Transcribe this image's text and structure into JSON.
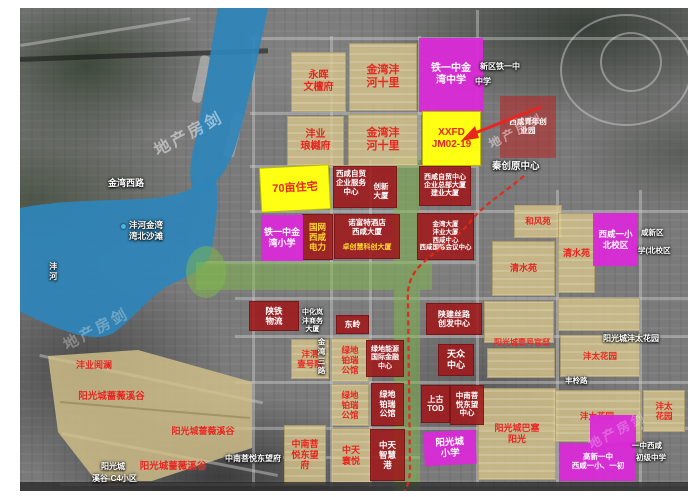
{
  "watermark": {
    "text": "地产房剑"
  },
  "parcels": {
    "yonghui_wentanfu": "永晖\n文檀府",
    "jinwan_fenghe_shili_n": "金湾沣\n河十里",
    "fengye_langyuefu": "沣业\n琅樾府",
    "jinwan_fenghe_shili_s": "金湾沣\n河十里",
    "tieyizhong_jinwan_zhongxue": "铁一中金\n湾中学",
    "xxfd": "XXFD\nJM02-19",
    "qishimu_zhuzhai": "70亩住宅",
    "ximao_fuwu": "西咸自贸\n企业服务\n中心",
    "chuangxin_dasha": "创新\n大厦",
    "ximao_zongbu": "西咸自贸中心\n企业总部大厦\n建业大厦",
    "qingnian_chuangyeyuan": "西咸青年创\n业园",
    "tieyizhong_jinwan_xiaoxue": "铁一中金\n湾小学",
    "guowang_dianli": "国网\n西咸\n电力",
    "nuofute_lines12": "诺富特酒店\n西咸大厦",
    "nuofute_line3": "卓创慧科创大厦",
    "jinwan_dasha": "金湾大厦\n沣业大厦\n西咸中心\n西咸国际会议中心",
    "hefengyuan": "和风苑",
    "qingshuiyuan_w": "清水苑",
    "qingshuiyuan_e": "清水苑",
    "xixian_yixiao_beixiaoqu": "西咸一小\n北校区",
    "shantie_wuliu": "陕铁\n物流",
    "dongling": "东岭",
    "fengwei_yihaoyuan": "沣渭\n壹号院",
    "lvdi_bairui_1": "绿地\n铂瑞\n公馆",
    "lvdi_nengyuan": "绿地能源\n国际金融\n中心",
    "lvdi_bairui_2": "绿地\n铂瑞\n公馆",
    "lvdi_bairui_3": "绿地\n铂瑞\n公馆",
    "shanjian_silu": "陕建丝路\n创发中心",
    "tianzhong_zhongxin": "天众\n中心",
    "shanggu_tod": "上古\nTOD",
    "zhongnan_dongwang_zhongxin": "中南菩\n悦东望\n中心",
    "fengye_yuelan": "沣业阅澜",
    "qiangwei_xigu_1": "阳光城蔷薇溪谷",
    "qiangwei_xigu_2": "阳光城蔷薇溪谷",
    "qiangwei_xigu_3": "阳光城蔷薇溪谷",
    "zhongnan_dongwangfu": "中南菩\n悦东望\n府",
    "zhongtian_huanyue": "中天\n寰悦",
    "zhongtian_zhihuigang": "中天\n智慧\n港",
    "yangguang_xiaoxue": "阳光城\n小学",
    "yihao_guandi": "阳光城壹号官邸",
    "fengtai_1": "沣太花园",
    "fengtai_2": "沣太花园",
    "fengtai_3": "沣太\n花园",
    "basai_yangguang": "阳光城巴塞\n阳光",
    "gaoxin_yizhong": "高新一中\n西咸一小、一初"
  },
  "labels": {
    "jinwan_xilu": "金湾西路",
    "fenghe_jinwan": "沣河金湾",
    "wanbei_shatan": "湾北沙滩",
    "fenghe": "沣河",
    "qinchuangyuan": "秦创原中心",
    "xinqu_tieyizhong": "新区铁一中",
    "zhongxue": "中学",
    "zhonghua_shangwu": "中化岚\n沣商务\n大厦",
    "jinwan_sanlu": "金湾三路",
    "yangguang_fengtai": "阳光城沣太花园",
    "fengling_lu": "丰柃路",
    "zhongnan_dongwangfu_w": "中南菩悦东望府",
    "c4_line1": "阳光城",
    "c4_line2": "溪谷-C4小区",
    "yizhong_frag": "一中西咸",
    "chuji_zhongxue": "初级中学",
    "xianxinqu_frag1": "咸新区",
    "xianxinqu_frag2": "学(北校区"
  },
  "colors": {
    "water": "#2e86ba",
    "green_corridor": "#80ba4c",
    "parcel_tan": "#d5c38b",
    "parcel_red": "#9e181a",
    "parcel_magenta": "#d82bd6",
    "parcel_yellow": "#ffff14",
    "annotation_red": "#e8251f"
  }
}
